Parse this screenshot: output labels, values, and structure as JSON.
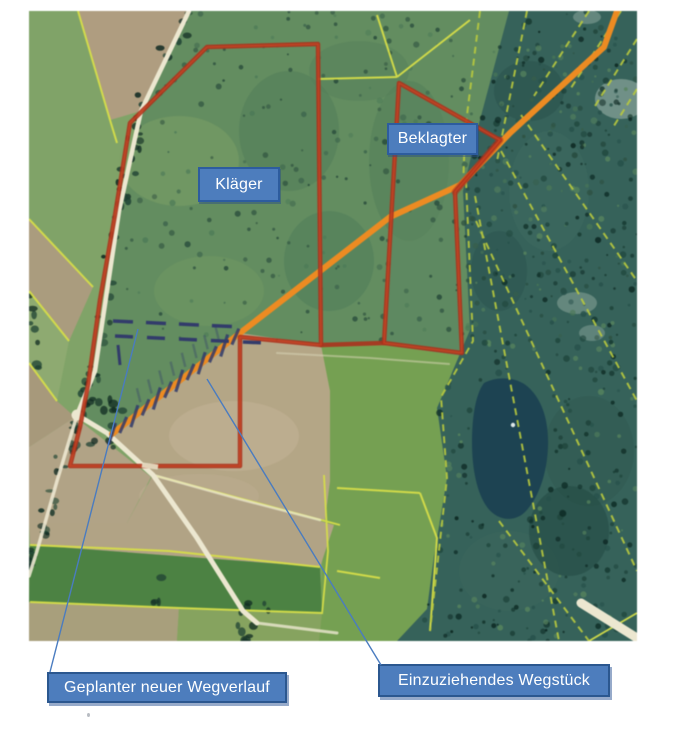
{
  "map": {
    "parcel_labels": {
      "klaeger": "Kläger",
      "beklagter": "Beklagter"
    },
    "callouts": {
      "planned_path": "Geplanter neuer Wegverlauf",
      "withdrawn_path": "Einzuziehendes Wegstück"
    },
    "colors": {
      "label_fill": "#4d7dbd",
      "label_border": "#2d5c9e",
      "label_text": "#ffffff",
      "leader_line": "#4a7cc0",
      "parcel_outline_red": "#b23019",
      "path_orange": "#f08a1c",
      "planned_path_blue": "#313b6d",
      "boundary_yellow": "#d6df42",
      "forest_boundary_yellow": "#b9cb38"
    }
  }
}
